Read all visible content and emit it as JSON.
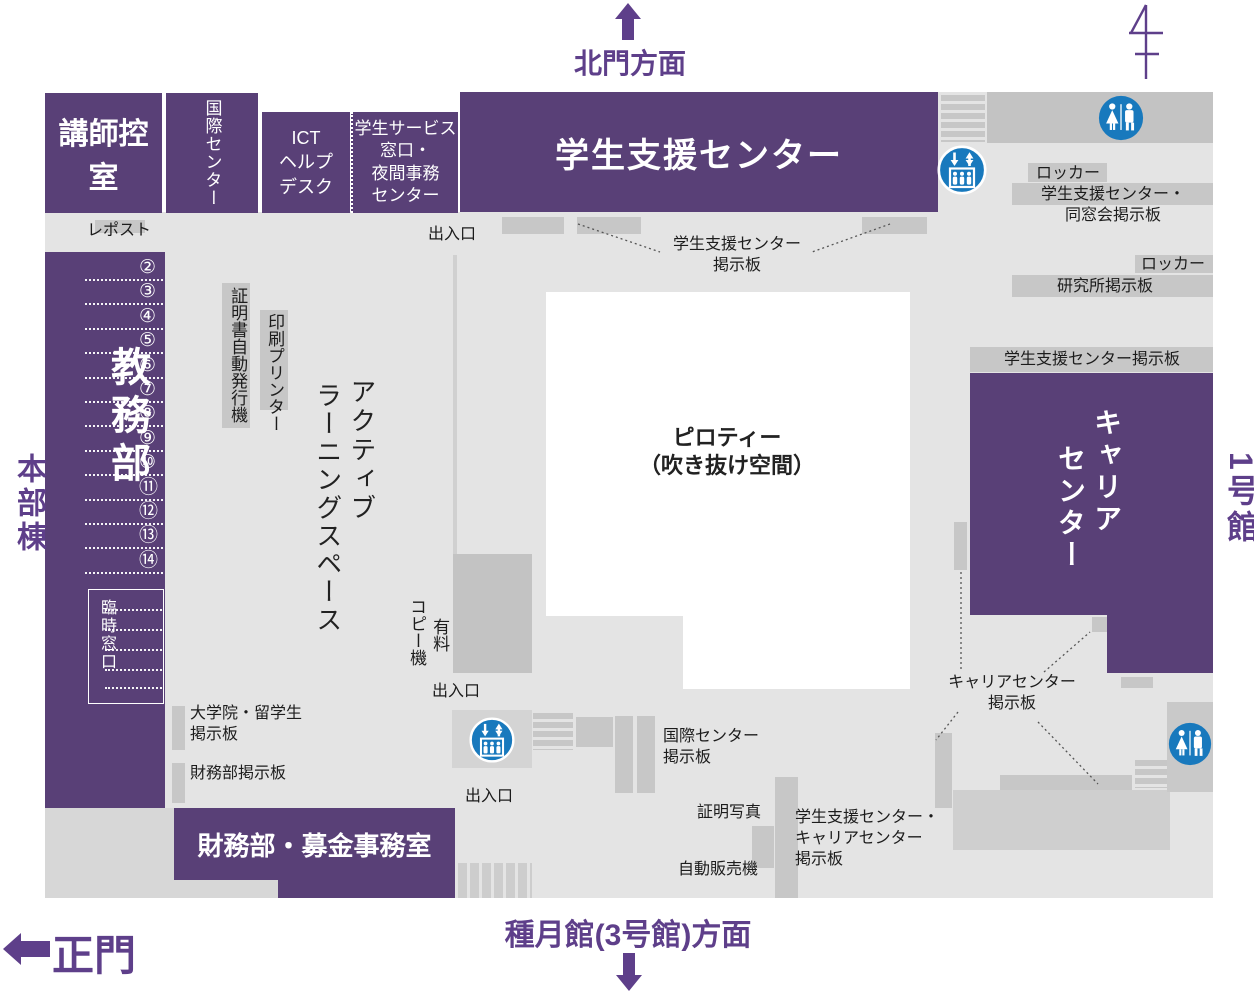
{
  "colors": {
    "purple": "#594077",
    "purple_text": "#5e3f8a",
    "floor": "#e4e4e4",
    "fixture": "#c7c7c7",
    "fixture_dark": "#c3c3c3",
    "strip": "#d7d7d7",
    "counter": "#cfcfcf",
    "blue": "#1879bd",
    "ink": "#1c1c1c"
  },
  "nav": {
    "north_label": "北門方面",
    "south_label": "種月館(3号館)方面",
    "west_label": "正門",
    "left_building": "本部棟",
    "right_building": "1号館"
  },
  "rooms": {
    "lecturer_lounge": "講師控室",
    "international_center": "国際センター",
    "ict_l1": "ICT",
    "ict_l2": "ヘルプ",
    "ict_l3": "デスク",
    "service_l1": "学生サービス",
    "service_l2": "窓口・",
    "service_l3": "夜間事務",
    "service_l4": "センター",
    "student_support_center": "学生支援センター",
    "academic_affairs": "教務部",
    "temporary_window": "臨時窓口",
    "finance_office": "財務部・募金事務室",
    "career_col1": "キャリア",
    "career_col2": "センター"
  },
  "areas": {
    "active_col1": "アクティブ",
    "active_col2": "ラーニングスペース",
    "pilotis_l1": "ピロティー",
    "pilotis_l2": "（吹き抜け空間）"
  },
  "windows": [
    "②",
    "③",
    "④",
    "⑤",
    "⑥",
    "⑦",
    "⑧",
    "⑨",
    "⑩",
    "⑪",
    "⑫",
    "⑬",
    "⑭"
  ],
  "labels": {
    "repost": "レポスト",
    "entrance": "出入口",
    "locker": "ロッカー",
    "support_board_l1": "学生支援センター",
    "support_board_l2": "掲示板",
    "alumni_board_l1": "学生支援センター・",
    "alumni_board_l2": "同窓会掲示板",
    "institute_board": "研究所掲示板",
    "support_center_board": "学生支援センター掲示板",
    "cert_machine": "証明書自動発行機",
    "printer": "印刷プリンター",
    "copier": "コピー機",
    "paid": "有料",
    "grad_board_l1": "大学院・留学生",
    "grad_board_l2": "掲示板",
    "finance_board": "財務部掲示板",
    "intl_board_l1": "国際センター",
    "intl_board_l2": "掲示板",
    "photo": "証明写真",
    "vending": "自動販売機",
    "support_career_l1": "学生支援センター・",
    "support_career_l2": "キャリアセンター",
    "support_career_l3": "掲示板",
    "career_board_l1": "キャリアセンター",
    "career_board_l2": "掲示板"
  },
  "icons": {
    "elevator": "elevator-icon",
    "toilet": "toilet-icon",
    "compass": "north-compass-icon",
    "north_arrow": "north-arrow-icon",
    "south_arrow": "south-arrow-icon",
    "west_arrow": "west-arrow-icon"
  }
}
